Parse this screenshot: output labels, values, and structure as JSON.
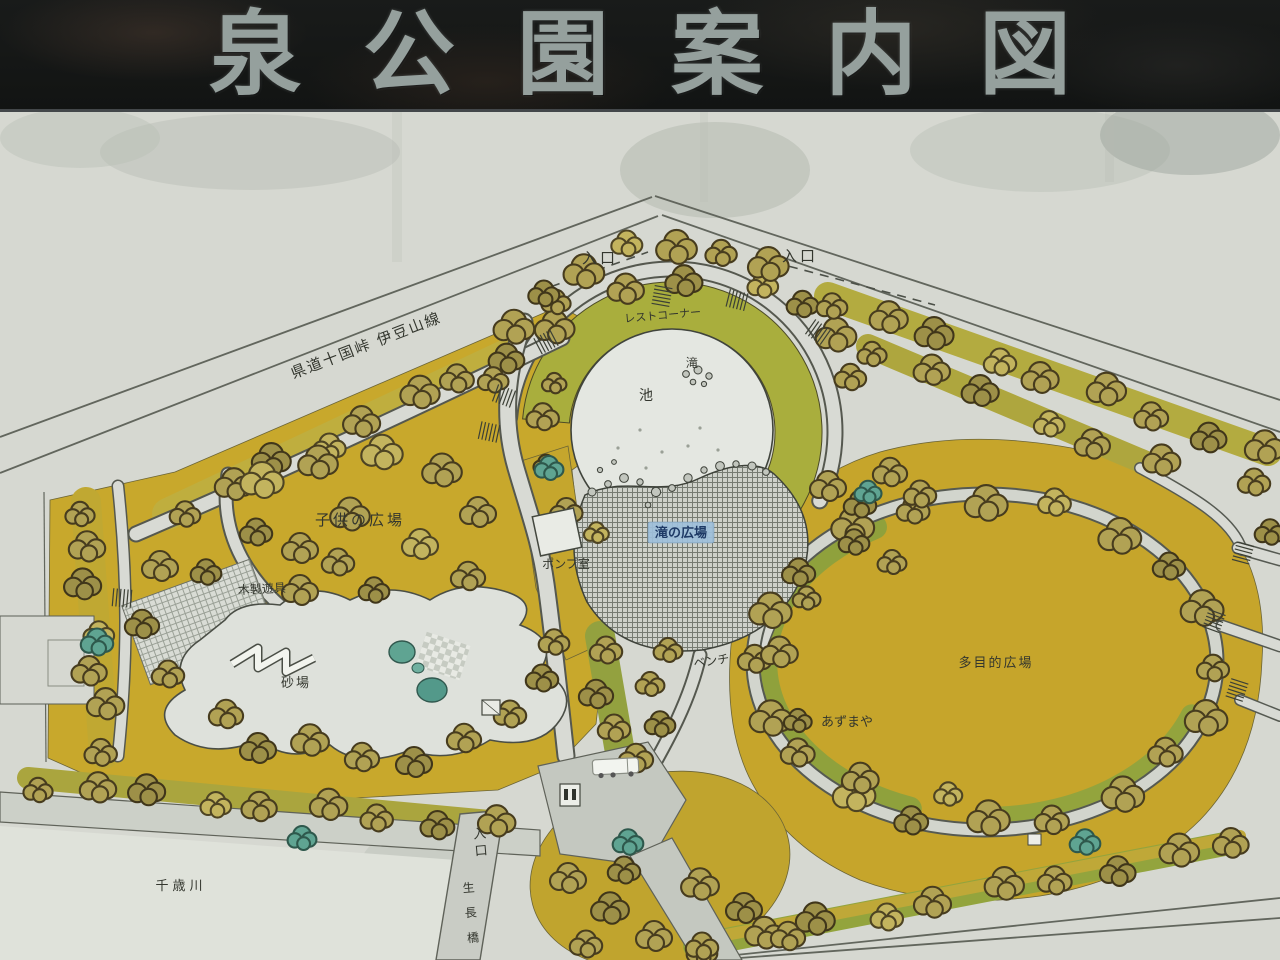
{
  "sign_board": {
    "title": "泉公園案内図"
  },
  "map": {
    "colors": {
      "board_bg": "#17191a",
      "title_text": "#95a09d",
      "paper": "#d6d8d1",
      "park_yellow": "#c8a82c",
      "tree_olive": "#b1a254",
      "tree_teal": "#5fa492",
      "greenway": "#95a43e",
      "path_gray": "#d8dad4",
      "plaza_hatch": "#767b72",
      "pond_fill": "#e4e7e1",
      "badge_blue": "#9fc0dc",
      "label_ink": "#33362e"
    },
    "labels": [
      {
        "id": "road-name",
        "text": "県道十国峠 伊豆山線",
        "x": 368,
        "y": 350,
        "size": 15,
        "rotate": -21,
        "spacing": 2
      },
      {
        "id": "entrance-top-left",
        "text": "入口",
        "x": 600,
        "y": 263,
        "size": 15,
        "spacing": 3
      },
      {
        "id": "entrance-top-right",
        "text": "入口",
        "x": 800,
        "y": 261,
        "size": 15,
        "spacing": 3
      },
      {
        "id": "rest-corner",
        "text": "レストコーナー",
        "x": 663,
        "y": 319,
        "size": 11,
        "rotate": -5
      },
      {
        "id": "waterfall",
        "text": "滝",
        "x": 692,
        "y": 367,
        "size": 12
      },
      {
        "id": "pond",
        "text": "池",
        "x": 646,
        "y": 400,
        "size": 14
      },
      {
        "id": "childrens-plaza",
        "text": "子供の広場",
        "x": 360,
        "y": 525,
        "size": 15,
        "spacing": 3
      },
      {
        "id": "wooden-playset",
        "text": "木製遊具",
        "x": 262,
        "y": 593,
        "size": 12,
        "rotate": -3
      },
      {
        "id": "pump-room",
        "text": "ポンプ室",
        "x": 566,
        "y": 568,
        "size": 12
      },
      {
        "id": "waterfall-plaza",
        "text": "滝の広場",
        "x": 681,
        "y": 537,
        "size": 13,
        "badge": true
      },
      {
        "id": "sandbox",
        "text": "砂場",
        "x": 296,
        "y": 687,
        "size": 13,
        "spacing": 2
      },
      {
        "id": "bench",
        "text": "ベンチ",
        "x": 712,
        "y": 665,
        "size": 12,
        "rotate": -8
      },
      {
        "id": "azumaya",
        "text": "あずまや",
        "x": 847,
        "y": 726,
        "size": 13
      },
      {
        "id": "multipurpose-plaza",
        "text": "多目的広場",
        "x": 996,
        "y": 667,
        "size": 13,
        "spacing": 2
      },
      {
        "id": "chitose-river",
        "text": "千歳川",
        "x": 181,
        "y": 890,
        "size": 13,
        "spacing": 4
      },
      {
        "id": "entrance-bottom",
        "text": "入口",
        "x": 480,
        "y": 838,
        "size": 13,
        "vertical": true,
        "vgap": 17,
        "rotate": -5
      },
      {
        "id": "seicho-bridge",
        "text": "生長橋",
        "x": 469,
        "y": 892,
        "size": 12,
        "vertical": true,
        "vgap": 25,
        "rotate": -5
      }
    ],
    "icons": [
      {
        "name": "truck-icon"
      },
      {
        "name": "toilet-sign-icon"
      },
      {
        "name": "pump-room-building-icon"
      },
      {
        "name": "pavilion-building-icon"
      },
      {
        "name": "tree-icon"
      },
      {
        "name": "stairs-icon"
      },
      {
        "name": "rock-icon"
      }
    ]
  }
}
